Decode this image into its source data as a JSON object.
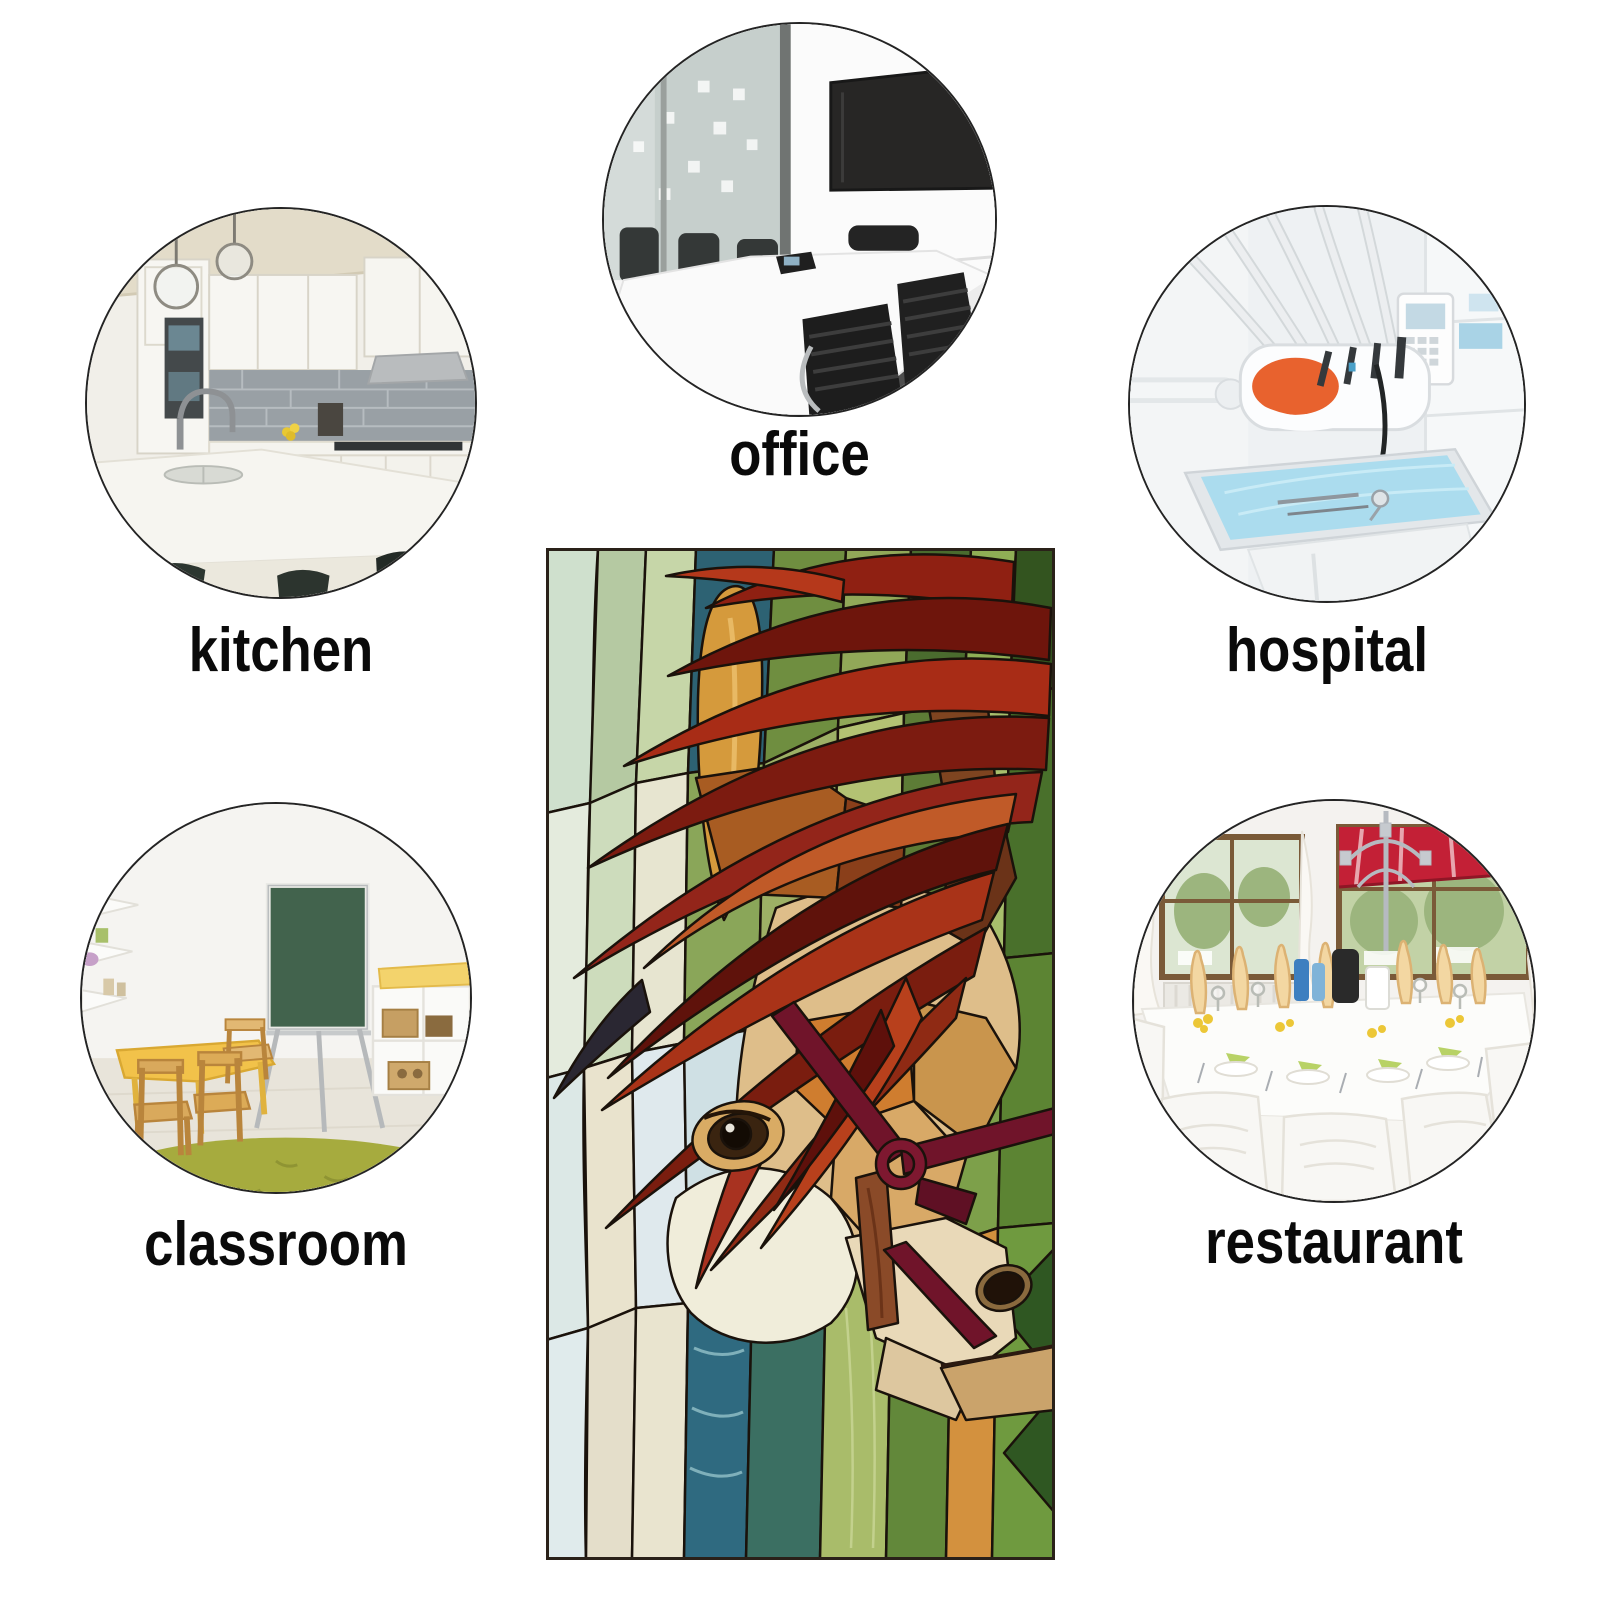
{
  "canvas": {
    "width_px": 1600,
    "height_px": 1600,
    "background": "#ffffff"
  },
  "caption_style": {
    "color": "#0a0a0a"
  },
  "scenes": {
    "kitchen": {
      "label": "kitchen"
    },
    "office": {
      "label": "office"
    },
    "hospital": {
      "label": "hospital"
    },
    "classroom": {
      "label": "classroom"
    },
    "restaurant": {
      "label": "restaurant"
    }
  },
  "center_panel": {
    "artwork": "stained glass horse with red mane among green leaves",
    "palette": {
      "mane_red": "#a82c16",
      "mane_dark": "#5f120b",
      "face_tan": "#d8a967",
      "blaze_cream": "#f0edda",
      "bridle_maroon": "#70142a",
      "leaf_green": "#6f8e40",
      "water_teal": "#2f6a80",
      "accent_orange": "#d3913e",
      "lead_line": "#1a120b"
    }
  }
}
